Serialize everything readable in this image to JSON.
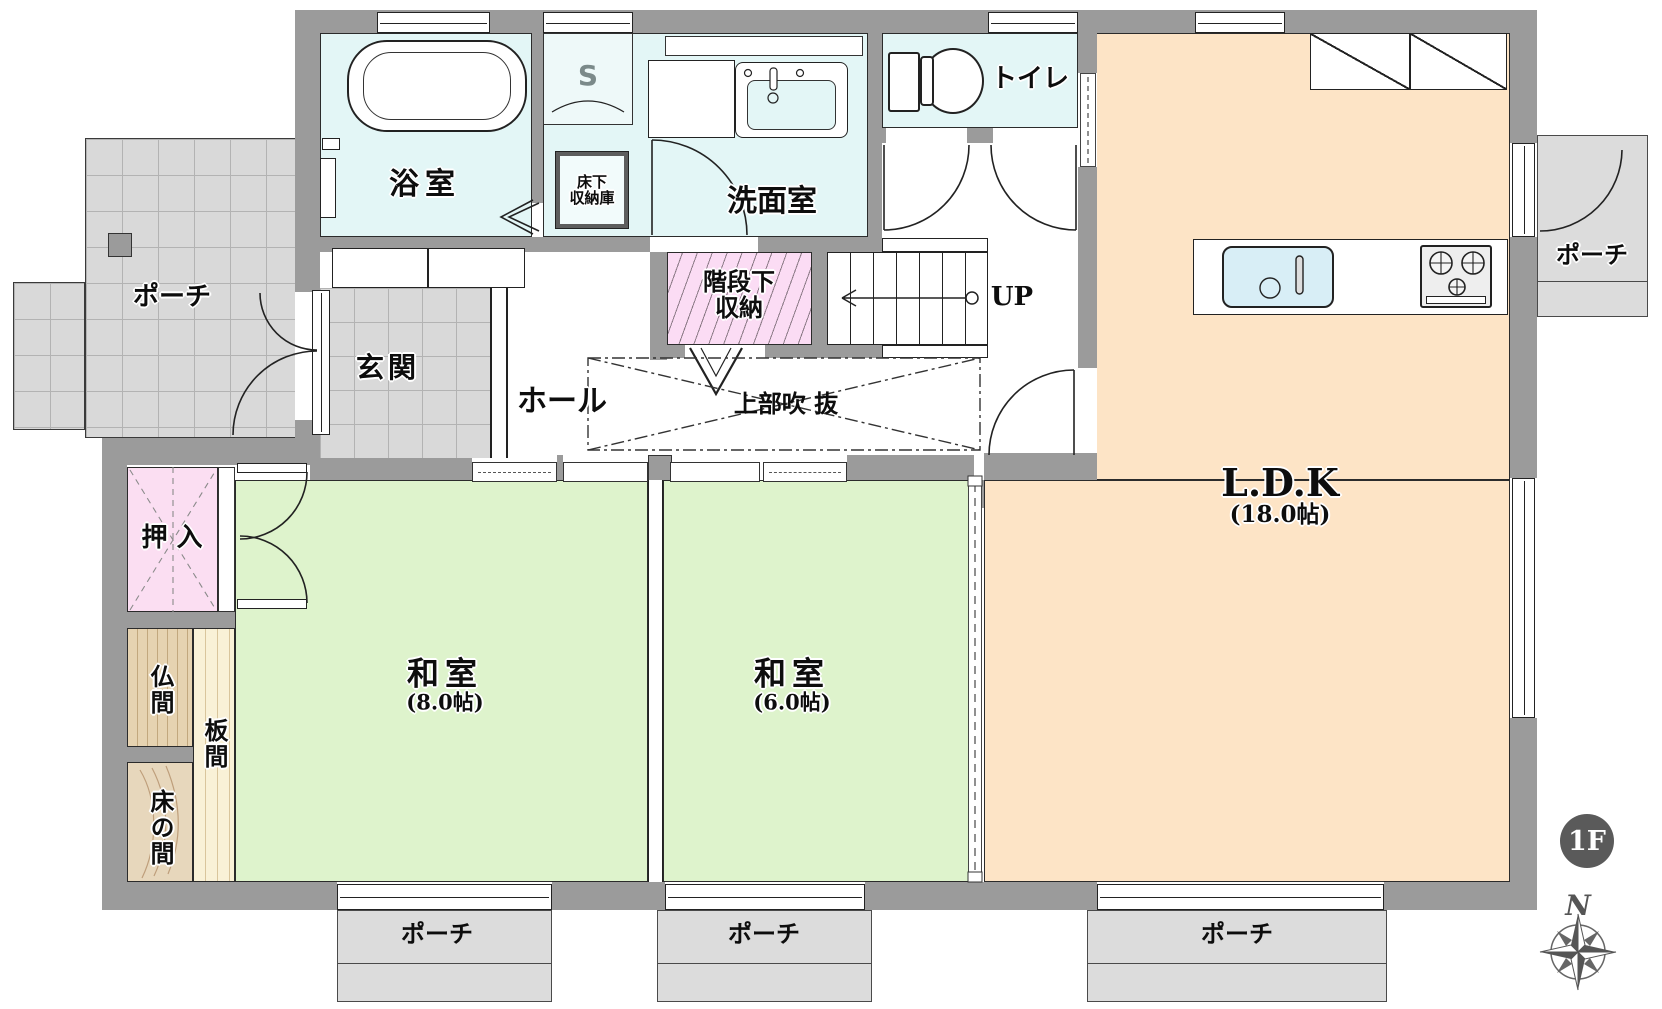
{
  "title": "1F floor plan",
  "floor_badge": "1F",
  "compass": {
    "north": "N"
  },
  "rooms": {
    "bath": "浴室",
    "shower_mark": "S",
    "underfloor_storage_l1": "床下",
    "underfloor_storage_l2": "収納庫",
    "washroom": "洗面室",
    "toilet": "トイレ",
    "entrance": "玄関",
    "hall": "ホール",
    "stair_storage_l1": "階段下",
    "stair_storage_l2": "収納",
    "stairs_up": "UP",
    "void_above": "上部吹 抜",
    "oshiire": "押 入",
    "butsuma": "仏間",
    "itanoma": "板間",
    "tokonoma": "床の間",
    "washitsu8": "和室",
    "washitsu8_size": "(8.0帖)",
    "washitsu6": "和室",
    "washitsu6_size": "(6.0帖)",
    "ldk": "L.D.K",
    "ldk_size": "(18.0帖)"
  },
  "porches": {
    "left": "ポーチ",
    "right": "ポーチ",
    "bottom1": "ポーチ",
    "bottom2": "ポーチ",
    "bottom3": "ポーチ"
  },
  "colors": {
    "wall": "#9b9b9b",
    "tatami": "#def3cc",
    "ldk": "#fde4c6",
    "wet_room": "#e3f6f6",
    "closet_pink": "#fbdef2",
    "hatch_pink": "#fbdcf4",
    "porch_gray": "#dcdcdc",
    "wood": "#e7d7bc",
    "badge": "#5a5a5a"
  }
}
